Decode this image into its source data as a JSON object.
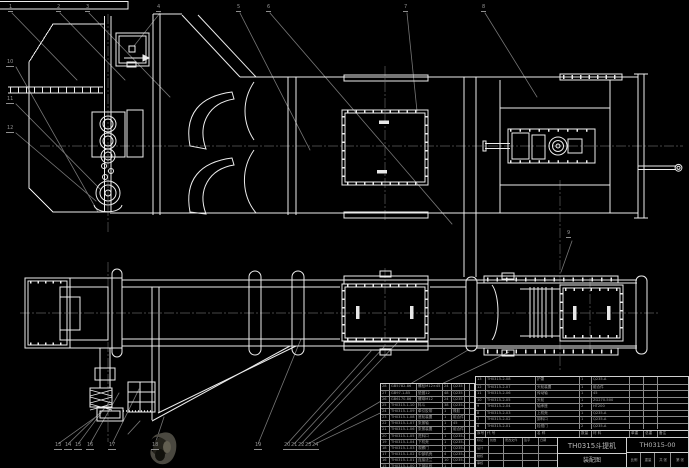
{
  "title_block": {
    "product": "TH0315斗提机",
    "sheet_name": "装配图",
    "drawing_no": "TH0315-00",
    "footer_row": [
      [
        "比例",
        "重量",
        "共 张",
        "第 张"
      ]
    ],
    "sign_rows": [
      [
        "标记",
        "处数",
        "更改文件",
        "签字",
        "日期"
      ],
      [
        "设计",
        "",
        "",
        "",
        ""
      ],
      [
        "校核",
        "",
        "",
        "",
        ""
      ],
      [
        "审核",
        "",
        "",
        "",
        ""
      ]
    ]
  },
  "bom_left": {
    "rows": [
      [
        "28",
        "GB5782-86",
        "螺栓M12×45",
        "24",
        "Q235",
        "",
        ""
      ],
      [
        "27",
        "GB97.1-85",
        "垫圈12",
        "48",
        "Q235",
        "",
        ""
      ],
      [
        "26",
        "GB6170-86",
        "螺母M12",
        "24",
        "Q235",
        "",
        ""
      ],
      [
        "25",
        "TH0315-1-10",
        "料斗",
        "38",
        "Q235-A",
        "",
        ""
      ],
      [
        "24",
        "TH0315-1-09",
        "牵引胶带",
        "1",
        "橡胶",
        "",
        ""
      ],
      [
        "23",
        "TH0315-1-08",
        "底轮装置",
        "1",
        "组合件",
        "",
        ""
      ],
      [
        "22",
        "TH0315-1-07",
        "张紧轴",
        "1",
        "45",
        "",
        ""
      ],
      [
        "21",
        "TH0315-1-06",
        "张紧装置",
        "2",
        "组合件",
        "",
        ""
      ],
      [
        "20",
        "TH0315-1-05",
        "进料口",
        "1",
        "Q235-A",
        "",
        ""
      ],
      [
        "19",
        "TH0315-1-04",
        "下机壳",
        "1",
        "Q235-A",
        "",
        ""
      ],
      [
        "18",
        "TH0315-1-03",
        "观察门",
        "1",
        "Q235-A",
        "",
        ""
      ],
      [
        "17",
        "TH0315-1-02",
        "中部机壳",
        "4",
        "Q235-A",
        "",
        ""
      ],
      [
        "16",
        "TH0315-1-01",
        "连接法兰",
        "10",
        "Q235-A",
        "",
        ""
      ],
      [
        "15",
        "TH0315-1-00",
        "下部区段",
        "1",
        "",
        "",
        ""
      ]
    ]
  },
  "bom_right": {
    "rows": [
      [
        "13",
        "TH0315-2-08",
        "护罩",
        "1",
        "Q235-A",
        "",
        "",
        ""
      ],
      [
        "12",
        "TH0315-2-07",
        "头轮装置",
        "1",
        "组合件",
        "",
        "",
        ""
      ],
      [
        "11",
        "TH0315-2-06",
        "传动轴",
        "1",
        "45",
        "",
        "",
        ""
      ],
      [
        "10",
        "TH0315-2-05",
        "头轮",
        "1",
        "ZG270-500",
        "",
        "",
        ""
      ],
      [
        "9",
        "TH0315-2-04",
        "轴承座",
        "2",
        "HT200",
        "",
        "",
        ""
      ],
      [
        "8",
        "TH0315-2-03",
        "上机壳",
        "1",
        "Q235-A",
        "",
        "",
        ""
      ],
      [
        "7",
        "TH0315-2-02",
        "卸料口",
        "1",
        "Q235-A",
        "",
        "",
        ""
      ],
      [
        "6",
        "TH0315-2-01",
        "检视门",
        "2",
        "Q235-A",
        "",
        "",
        ""
      ]
    ],
    "header_row": [
      [
        "序号",
        "代  号",
        "名  称",
        "数量",
        "材  料",
        "单重",
        "总重",
        "备注"
      ]
    ]
  },
  "balloons": {
    "top": [
      "1",
      "2",
      "3",
      "4",
      "5",
      "6",
      "7",
      "8"
    ],
    "mid": [
      "9"
    ],
    "left": [
      "10",
      "11",
      "12"
    ],
    "bottom": [
      "13",
      "14",
      "15",
      "16",
      "17",
      "18",
      "19",
      "20",
      "21",
      "22",
      "23",
      "24"
    ]
  },
  "colors": {
    "background": "#000000",
    "line": "#ececec",
    "leader": "#777777",
    "table_text": "#a6a6a6",
    "stamp": "#3c3a2f"
  }
}
